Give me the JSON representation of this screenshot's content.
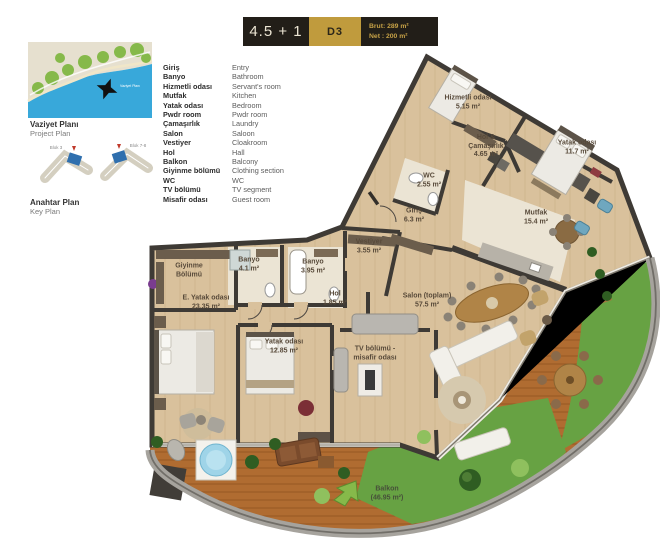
{
  "header": {
    "layout_type": "4.5 + 1",
    "unit": "D3",
    "brut": "Brut: 289 m²",
    "net": "Net : 200 m²"
  },
  "project_plan": {
    "title": "Vaziyet Planı",
    "subtitle": "Project Plan",
    "map_watermark": "Vaziyet Planı"
  },
  "key_plan": {
    "title": "Anahtar Plan",
    "subtitle": "Key Plan",
    "block_left": "Blok 3",
    "block_right": "Blok 7-8"
  },
  "legend": {
    "items": [
      {
        "tr": "Giriş",
        "en": "Entry"
      },
      {
        "tr": "Banyo",
        "en": "Bathroom"
      },
      {
        "tr": "Hizmetli odası",
        "en": "Servant's room"
      },
      {
        "tr": "Mutfak",
        "en": "Kitchen"
      },
      {
        "tr": "Yatak odası",
        "en": "Bedroom"
      },
      {
        "tr": "Pwdr room",
        "en": "Pwdr room"
      },
      {
        "tr": "Çamaşırlık",
        "en": "Laundry"
      },
      {
        "tr": "Salon",
        "en": "Saloon"
      },
      {
        "tr": "Vestiyer",
        "en": "Cloakroom"
      },
      {
        "tr": "Hol",
        "en": "Hall"
      },
      {
        "tr": "Balkon",
        "en": "Balcony"
      },
      {
        "tr": "Giyinme bölümü",
        "en": "Clothing section"
      },
      {
        "tr": "WC",
        "en": "WC"
      },
      {
        "tr": "TV bölümü",
        "en": "TV segment"
      },
      {
        "tr": "Misafir odası",
        "en": "Guest room"
      }
    ]
  },
  "plan": {
    "rooms": [
      {
        "name": "Hizmetli odası",
        "area": "5.15 m²"
      },
      {
        "name": "Hol &",
        "name2": "Çamaşırlık",
        "area": "4.65 m²"
      },
      {
        "name": "Yatak odası",
        "area": "11.7 m²"
      },
      {
        "name": "WC",
        "area": "2.55 m²"
      },
      {
        "name": "Mutfak",
        "area": "15.4 m²"
      },
      {
        "name": "Giriş",
        "area": "6.3 m²"
      },
      {
        "name": "Vestiyer",
        "area": "3.55 m²"
      },
      {
        "name": "Banyo",
        "area": "4.1 m²"
      },
      {
        "name": "Banyo",
        "area": "3.95 m²"
      },
      {
        "name": "Giyinme",
        "name2": "Bölümü"
      },
      {
        "name": "E. Yatak odası",
        "area": "23.35 m²"
      },
      {
        "name": "Hol",
        "area": "1.85 m²"
      },
      {
        "name": "Yatak odası",
        "area": "12.85 m²"
      },
      {
        "name": "TV bölümü -",
        "name2": "misafir odası"
      },
      {
        "name": "Salon (toplam)",
        "area": "57.5 m²"
      },
      {
        "name": "Balkon",
        "area": "(46.95 m²)"
      }
    ]
  },
  "colors": {
    "accent_gold": "#c09b3d",
    "header_dark": "#221e18",
    "wall": "#3e3a35",
    "wood_floor": "#d9c19c",
    "tile_floor": "#ebe4d4",
    "deck": "#b06c31",
    "grass": "#67a243",
    "sea": "#38a8da"
  }
}
